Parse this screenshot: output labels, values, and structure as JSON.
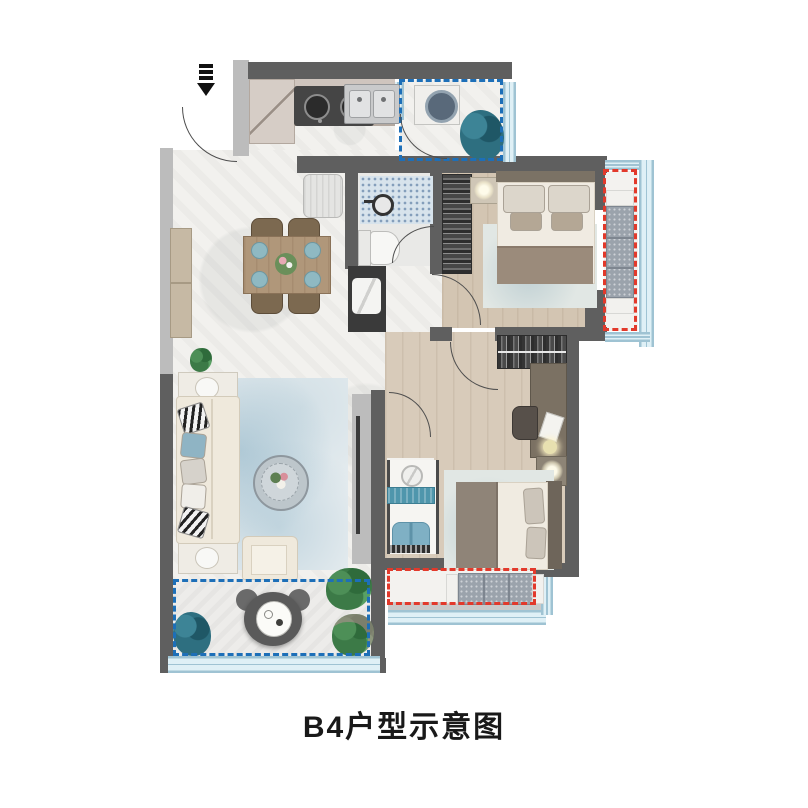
{
  "title": "B4户型示意图",
  "icons": {
    "entry": "entry-arrow-icon"
  },
  "colors": {
    "wall": "#5f5f5f",
    "wall_light": "#bcbcbc",
    "floor_marble": "#f2f1ee",
    "floor_wood": "#d8cbba",
    "glass_line": "#9fc3d3",
    "dash_blue": "#1d6fb8",
    "dash_red": "#e2392b",
    "bench": "#9ba3ac",
    "accent_chair": "#7fb0c4",
    "plant_green": "#3c7a47",
    "plant_teal": "#2e6f80"
  }
}
